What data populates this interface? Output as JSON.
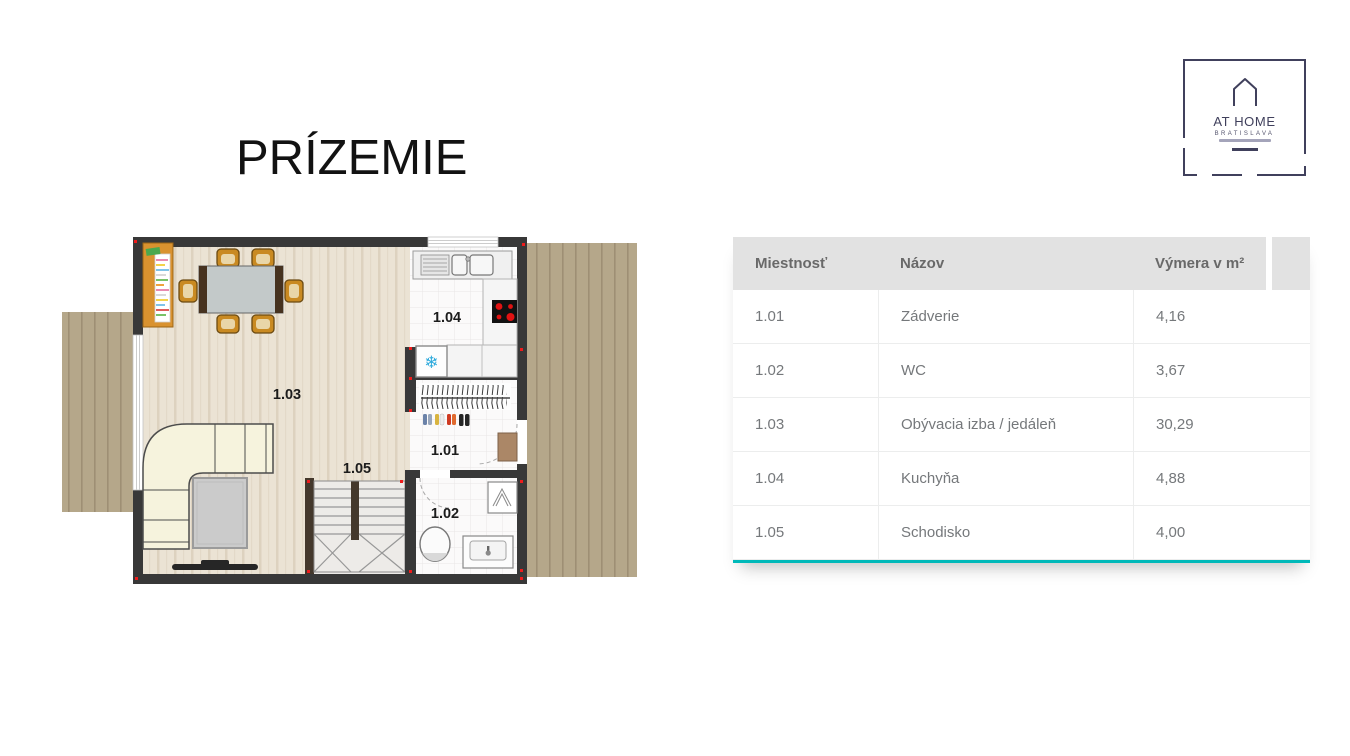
{
  "title": "PRÍZEMIE",
  "logo": {
    "brand": "AT HOME",
    "city": "BRATISLAVA"
  },
  "floorplan": {
    "labels": {
      "hall": "1.01",
      "wc": "1.02",
      "living": "1.03",
      "kitchen": "1.04",
      "stairs": "1.05"
    }
  },
  "icons": {
    "snowflake": "❄"
  },
  "table": {
    "columns": [
      "Miestnosť",
      "Názov",
      "Výmera v m²"
    ],
    "rows": [
      {
        "id": "1.01",
        "name": "Zádverie",
        "area": "4,16"
      },
      {
        "id": "1.02",
        "name": "WC",
        "area": "3,67"
      },
      {
        "id": "1.03",
        "name": "Obývacia izba / jedáleň",
        "area": "30,29"
      },
      {
        "id": "1.04",
        "name": "Kuchyňa",
        "area": "4,88"
      },
      {
        "id": "1.05",
        "name": "Schodisko",
        "area": "4,00"
      }
    ]
  },
  "colors": {
    "accent": "#00b9b9",
    "wall": "#383838",
    "deck": "#b5a78a",
    "wood_floor": "#ebe3d4",
    "logo_navy": "#40405c",
    "marker_red": "#ee1c1c"
  }
}
